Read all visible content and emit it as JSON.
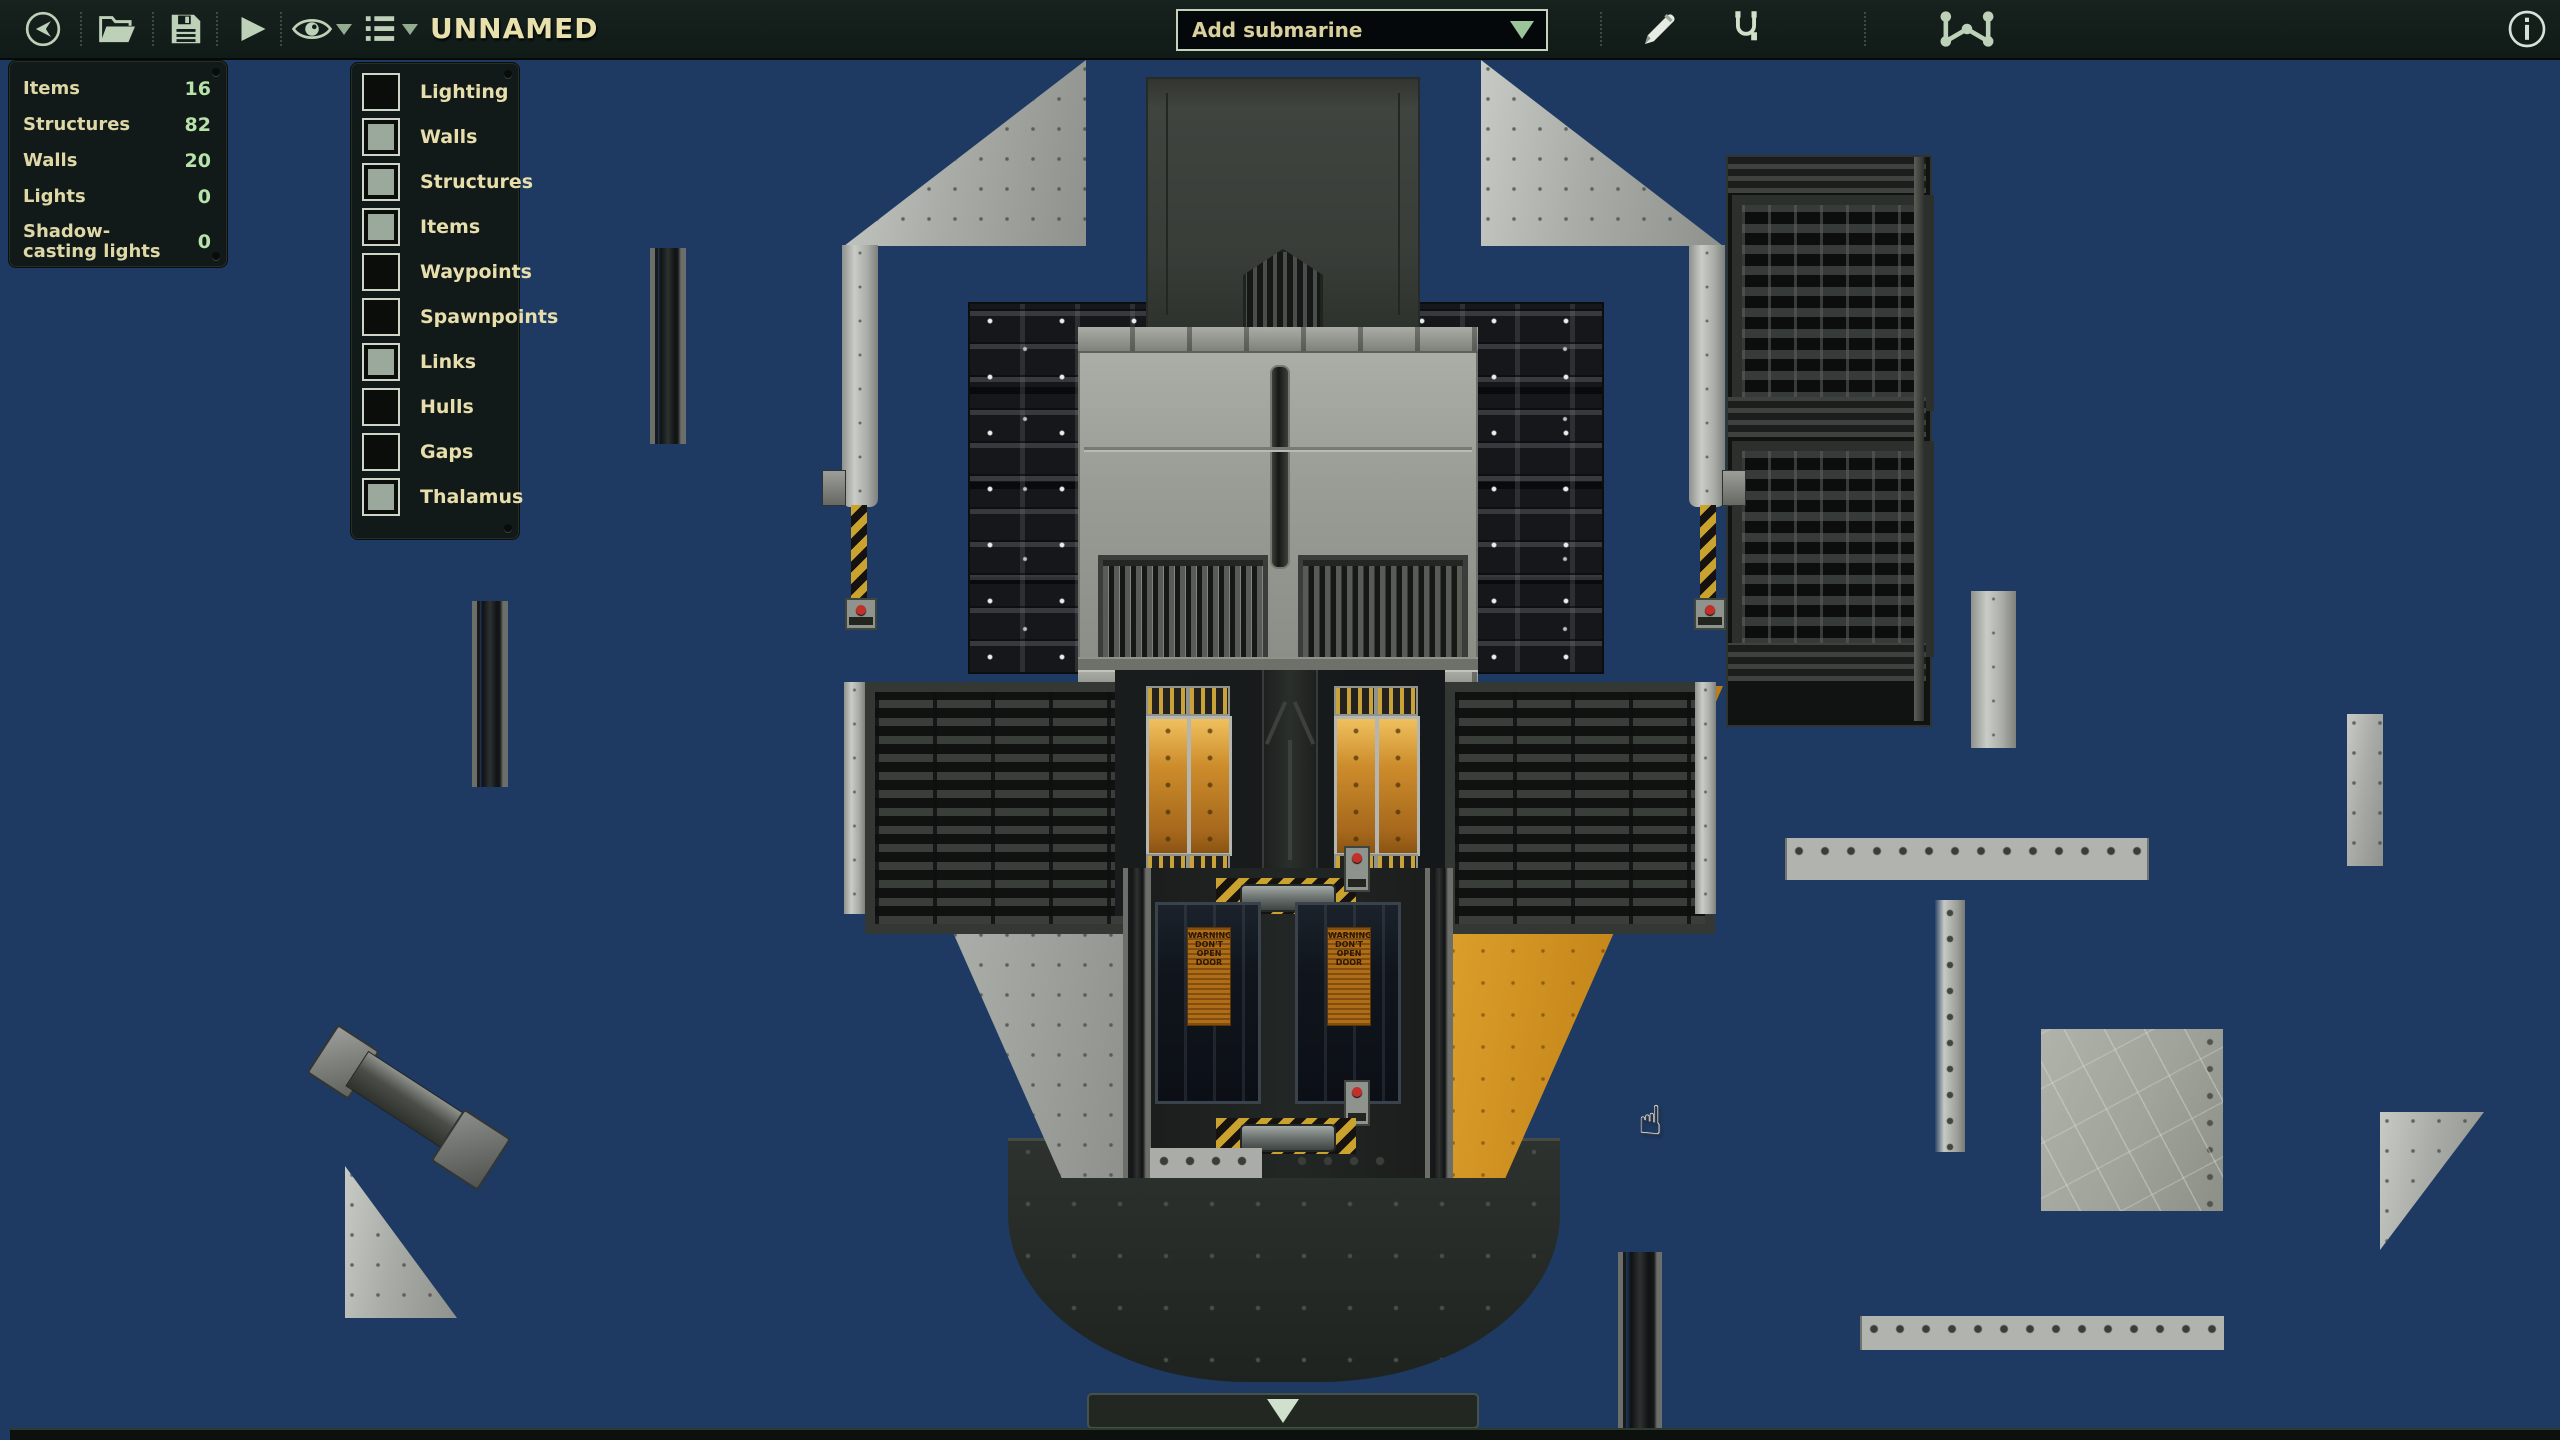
{
  "toolbar": {
    "title": "UNNAMED",
    "add_submarine_label": "Add submarine",
    "icons": {
      "back": "circle-arrow-left-icon",
      "open": "folder-open-icon",
      "save": "floppy-disk-icon",
      "play": "play-icon",
      "visibility": "eye-icon",
      "entity_list": "list-icon",
      "edit": "pencil-icon",
      "wiring": "wire-icon",
      "waypoints": "waypoint-nodes-icon",
      "info": "info-circle-icon"
    }
  },
  "stats_panel": {
    "rows": [
      {
        "label": "Items",
        "value": "16"
      },
      {
        "label": "Structures",
        "value": "82"
      },
      {
        "label": "Walls",
        "value": "20"
      },
      {
        "label": "Lights",
        "value": "0"
      },
      {
        "label": "Shadow-casting lights",
        "value": "0"
      }
    ]
  },
  "layers_panel": {
    "items": [
      {
        "label": "Lighting",
        "checked": false
      },
      {
        "label": "Walls",
        "checked": true
      },
      {
        "label": "Structures",
        "checked": true
      },
      {
        "label": "Items",
        "checked": true
      },
      {
        "label": "Waypoints",
        "checked": false
      },
      {
        "label": "Spawnpoints",
        "checked": false
      },
      {
        "label": "Links",
        "checked": true
      },
      {
        "label": "Hulls",
        "checked": false
      },
      {
        "label": "Gaps",
        "checked": false
      },
      {
        "label": "Thalamus",
        "checked": true
      }
    ]
  },
  "canvas": {
    "warning_poster": "WARNING DON'T OPEN DOOR",
    "cursor": "hand-pointer",
    "bottom_bar_icon": "chevron-down-icon"
  },
  "colors": {
    "canvas_navy": "#1e3a63",
    "toolbar_bg": "#131d1a",
    "panel_bg": "#101813",
    "label_tan": "#ded8a6",
    "value_green": "#b7e3ab",
    "icon_sage": "#bdd0b8",
    "hull_silver": "#a9aca7",
    "hull_orange": "#c8891c",
    "hazard_yellow": "#c9a32d",
    "poster_orange": "#b06d17"
  }
}
